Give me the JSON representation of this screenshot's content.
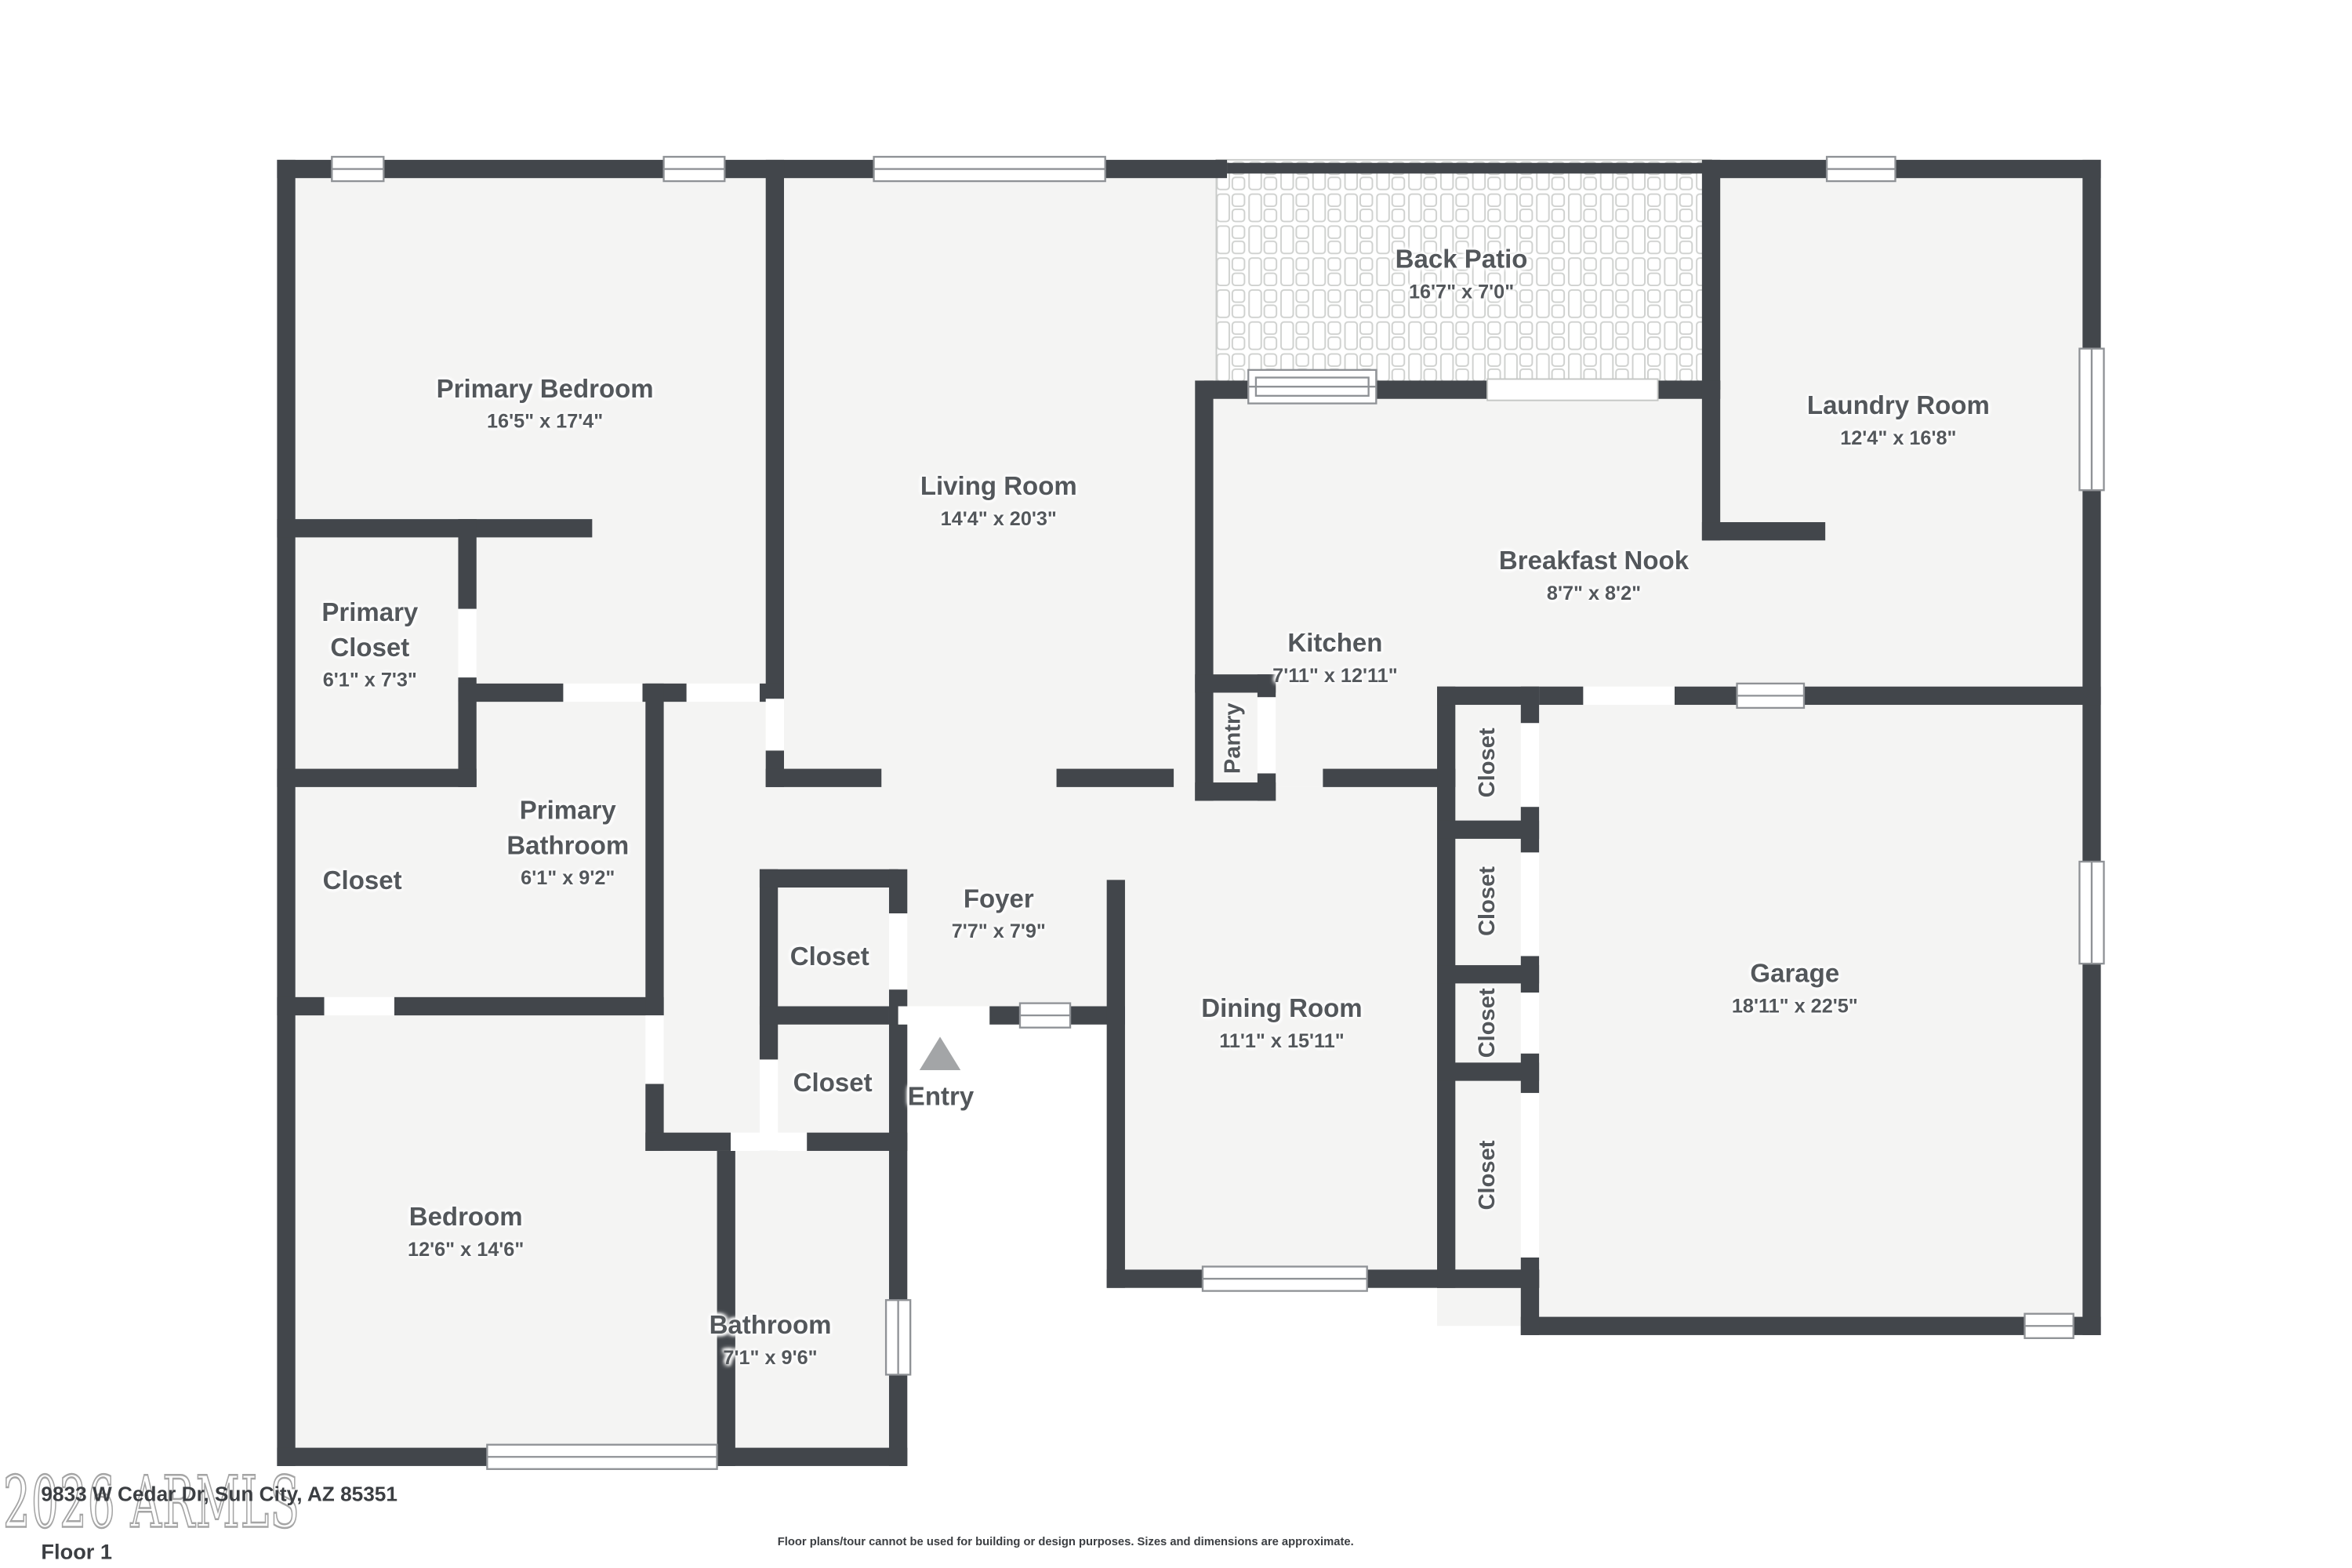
{
  "meta": {
    "type": "real-estate floor plan",
    "floor_label": "Floor 1",
    "address": "9833 W Cedar Dr, Sun City, AZ 85351",
    "watermark": "2026 ARMLS",
    "disclaimer": "Floor plans/tour cannot be used for building or design purposes. Sizes and dimensions are approximate."
  },
  "colors": {
    "wall": "#42464b",
    "floor": "#f4f4f3",
    "label": "#53575b",
    "winframe": "#8f9296",
    "patioline": "#c9cbc9",
    "entry": "#a3a5a7",
    "wmstroke": "#a5a5a5",
    "ink": "#3b3e42"
  },
  "rooms": [
    {
      "name": "Primary Bedroom",
      "dims": "16'5\" x 17'4\""
    },
    {
      "name": "Living Room",
      "dims": "14'4\" x 20'3\""
    },
    {
      "name": "Back Patio",
      "dims": "16'7\" x 7'0\""
    },
    {
      "name": "Laundry Room",
      "dims": "12'4\" x 16'8\""
    },
    {
      "name": "Breakfast Nook",
      "dims": "8'7\" x 8'2\""
    },
    {
      "name": "Kitchen",
      "dims": "7'11\" x 12'11\""
    },
    {
      "name": "Primary Closet",
      "dims": "6'1\" x 7'3\""
    },
    {
      "name": "Primary Bathroom",
      "dims": "6'1\" x 9'2\""
    },
    {
      "name": "Closet",
      "dims": ""
    },
    {
      "name": "Foyer",
      "dims": "7'7\" x 7'9\""
    },
    {
      "name": "Closet",
      "dims": ""
    },
    {
      "name": "Closet",
      "dims": ""
    },
    {
      "name": "Entry",
      "dims": ""
    },
    {
      "name": "Dining Room",
      "dims": "11'1\" x 15'11\""
    },
    {
      "name": "Bedroom",
      "dims": "12'6\" x 14'6\""
    },
    {
      "name": "Bathroom",
      "dims": "7'1\" x 9'6\""
    },
    {
      "name": "Garage",
      "dims": "18'11\" x 22'5\""
    },
    {
      "name": "Pantry",
      "dims": ""
    },
    {
      "name": "Closet",
      "dims": ""
    },
    {
      "name": "Closet",
      "dims": ""
    },
    {
      "name": "Closet",
      "dims": ""
    },
    {
      "name": "Closet",
      "dims": ""
    }
  ]
}
